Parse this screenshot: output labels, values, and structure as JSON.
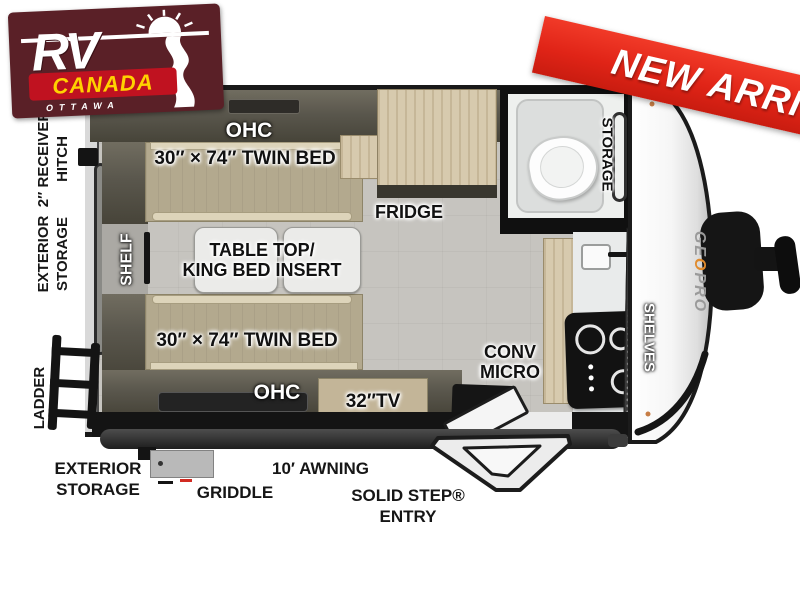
{
  "branding": {
    "dealer_logo": {
      "rv": "RV",
      "canada": "CANADA",
      "city": "OTTAWA"
    },
    "ribbon": {
      "text": "NEW ARRIVAL",
      "color": "#e02417"
    },
    "model_mark": {
      "part1": "GE",
      "part2": "O",
      "part3": " PRO"
    }
  },
  "floorplan": {
    "exterior_left": {
      "hitch_line1": "2″ RECEIVER",
      "hitch_line2": "HITCH",
      "storage_line1": "EXTERIOR",
      "storage_line2": "STORAGE",
      "ladder": "LADDER"
    },
    "interior": {
      "ohc_top": "OHC",
      "twin_bed_top": "30″ × 74″ TWIN BED",
      "shelf": "SHELF",
      "table_line1": "TABLE TOP/",
      "table_line2": "KING BED INSERT",
      "fridge": "FRIDGE",
      "bath_storage": "STORAGE",
      "twin_bed_bottom": "30″ × 74″ TWIN BED",
      "ohc_bottom": "OHC",
      "tv": "32″TV",
      "conv_line1": "CONV",
      "conv_line2": "MICRO",
      "shelves": "SHELVES"
    },
    "exterior_bottom": {
      "storage_line1": "EXTERIOR",
      "storage_line2": "STORAGE",
      "griddle": "GRIDDLE",
      "awning": "10′ AWNING",
      "entry_line1": "SOLID STEP®",
      "entry_line2": "ENTRY"
    }
  },
  "colors": {
    "logo_maroon": "#5a2027",
    "logo_red_band": "#c01220",
    "logo_yellow": "#ffd200",
    "ribbon_red": "#e02417",
    "bed_tan": "#b3a98e",
    "cabinet_olive": "#5a574d",
    "wood": "#d7caae",
    "floor_gray": "#c6c4bf",
    "wall_black": "#191919",
    "brand_orange": "#e08b2d"
  }
}
